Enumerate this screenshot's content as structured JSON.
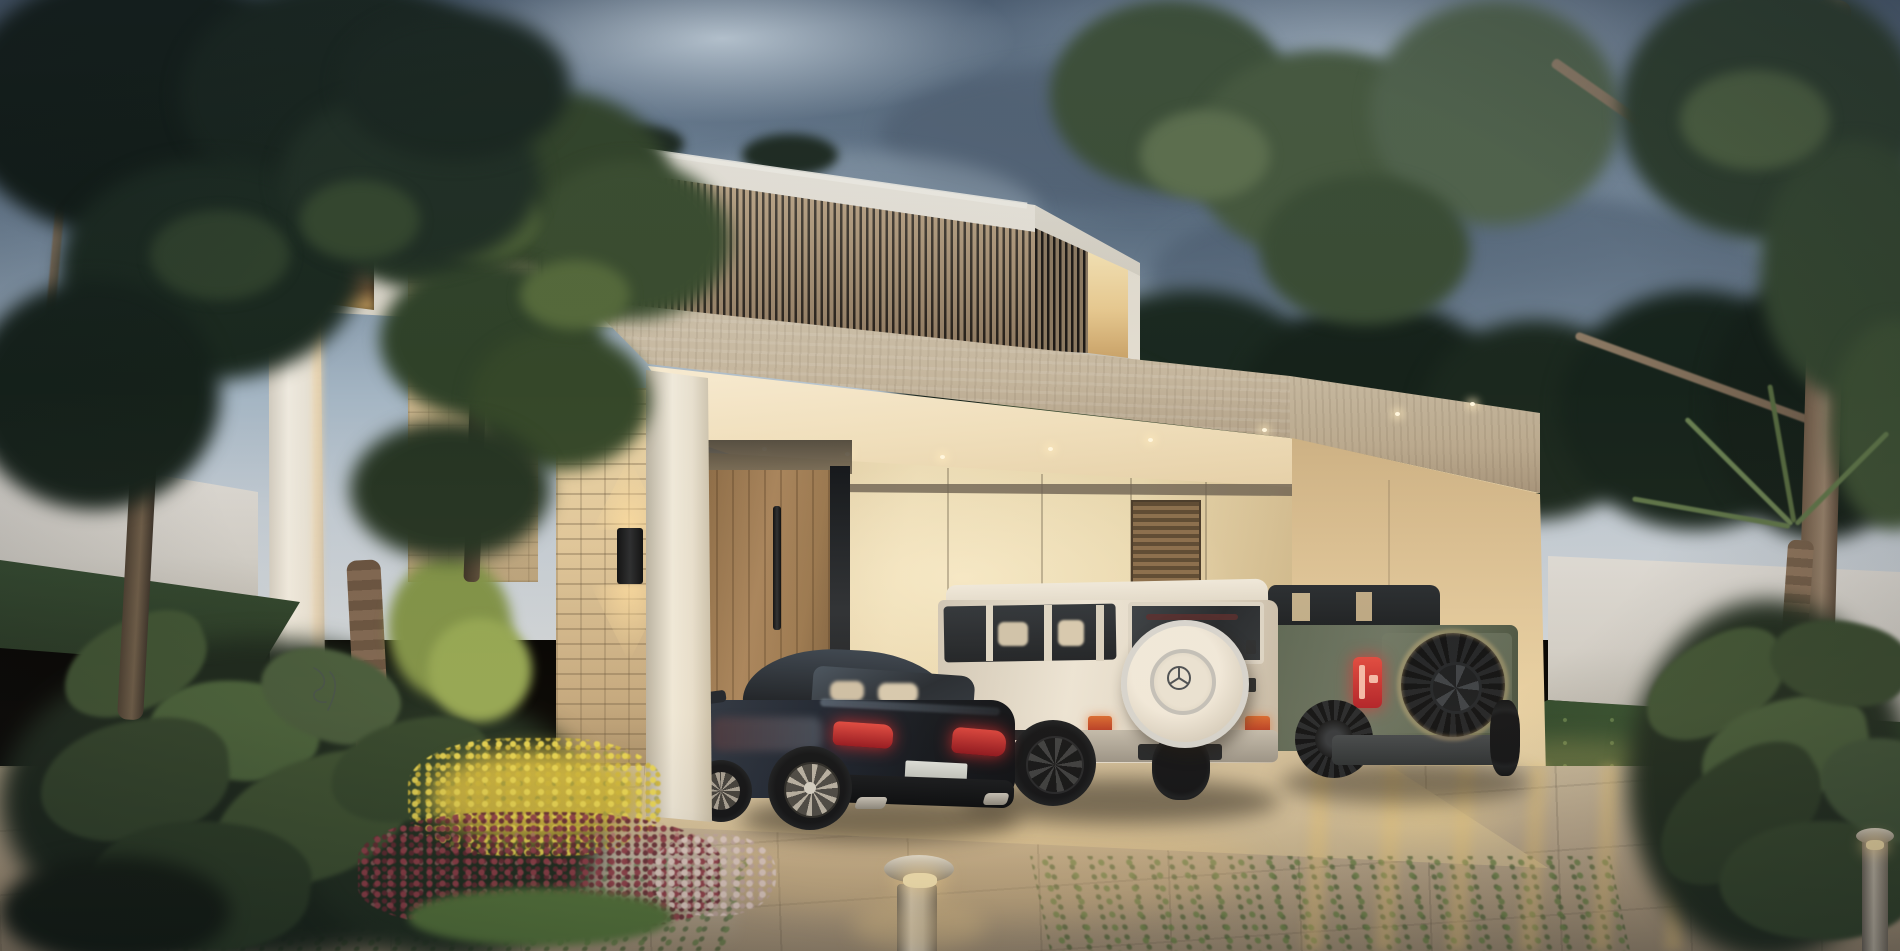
{
  "scene": {
    "description": "Photorealistic dusk rendering of a modern two-storey villa with a vertical timber-slat facade and a travertine flat-roof carport sheltering three vehicles",
    "time_of_day": "dusk",
    "visible_text": "none"
  },
  "palette": {
    "sky_top": "#4e5f73",
    "sky_light": "#c0c9d2",
    "cloud_dark": "#546678",
    "foliage_dark": "#15211a",
    "foliage_mid": "#2f4128",
    "foliage_light": "#55693a",
    "house_white": "#eae6dd",
    "timber_slat": "#b69d7e",
    "slat_gap": "#241f1a",
    "travertine": "#c9bba3",
    "stone_warm": "#d9c29c",
    "door_timber": "#9a7a55",
    "ceiling_warm": "#f4e6c4",
    "interior_wall": "#ead9b2",
    "right_wall_warm": "#e2cfa4",
    "perimeter_wall": "#d7d4cf",
    "driveway": "#c3b59c",
    "lawn": "#2c4230",
    "sedan_body": "#1d2530",
    "suv_white_body": "#e6dfd2",
    "suv_green_body": "#5a6553",
    "taillight_red": "#c0282e",
    "glow_warm": "#ffe9b0"
  },
  "objects": {
    "sky": "Overcast dusk sky with blue-grey cloud banks",
    "house": "Modern white villa, lit window and warm-lit slat niche",
    "carport": "Travertine canopy with recessed downlights and beige panel back wall with louver vent",
    "sedan": "Dark blue luxury fastback sedan seen from rear",
    "suv_white": "White boxy luxury SUV with chrome-ringed rear spare wheel",
    "suv_green": "Green off-road SUV with black rear-mounted spare tire and red vertical taillights",
    "entry_door": "Tall timber entry door with long black pull handle",
    "stone_wall": "Rough stone feature wall with black up/down sconce",
    "bollard_light": "Stainless steel bollard path light, glowing",
    "flower_bed": "Garden bed of yellow, burgundy and white blooms with monstera leaves",
    "driveway": "Concrete paver driveway with grass joints and warm light reflections",
    "perimeter_wall": "White boundary walls backed by dense tropical trees"
  }
}
